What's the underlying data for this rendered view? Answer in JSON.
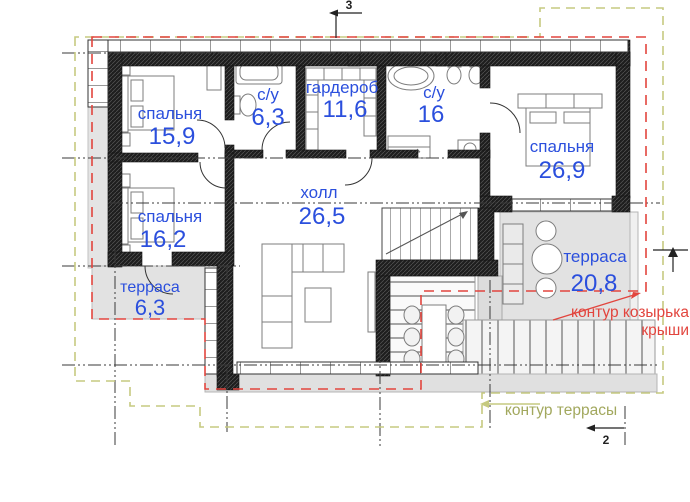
{
  "rooms": {
    "bedroom_top_left": {
      "label": "спальня",
      "area": "15,9"
    },
    "bathroom_small": {
      "label": "с/у",
      "area": "6,3"
    },
    "wardrobe": {
      "label": "гардероб",
      "area": "11,6"
    },
    "bathroom_large": {
      "label": "с/у",
      "area": "16"
    },
    "bedroom_right": {
      "label": "спальня",
      "area": "26,9"
    },
    "bedroom_bottom_left": {
      "label": "спальня",
      "area": "16,2"
    },
    "hall": {
      "label": "холл",
      "area": "26,5"
    },
    "terrace_left": {
      "label": "терраса",
      "area": "6,3"
    },
    "terrace_right": {
      "label": "терраса",
      "area": "20,8"
    }
  },
  "annotations": {
    "roof_contour": {
      "line1": "контур козырька",
      "line2": "крыши"
    },
    "terrace_contour": {
      "label": "контур террасы"
    }
  },
  "section_markers": {
    "top": "3",
    "bottom_right": "2"
  },
  "colors": {
    "room_label": "#2b4fdd",
    "roof_contour": "#e2453e",
    "terrace_contour": "#a2a85e",
    "terrace_contour_line": "#c6ca80",
    "wall": "#1e1e1e"
  }
}
